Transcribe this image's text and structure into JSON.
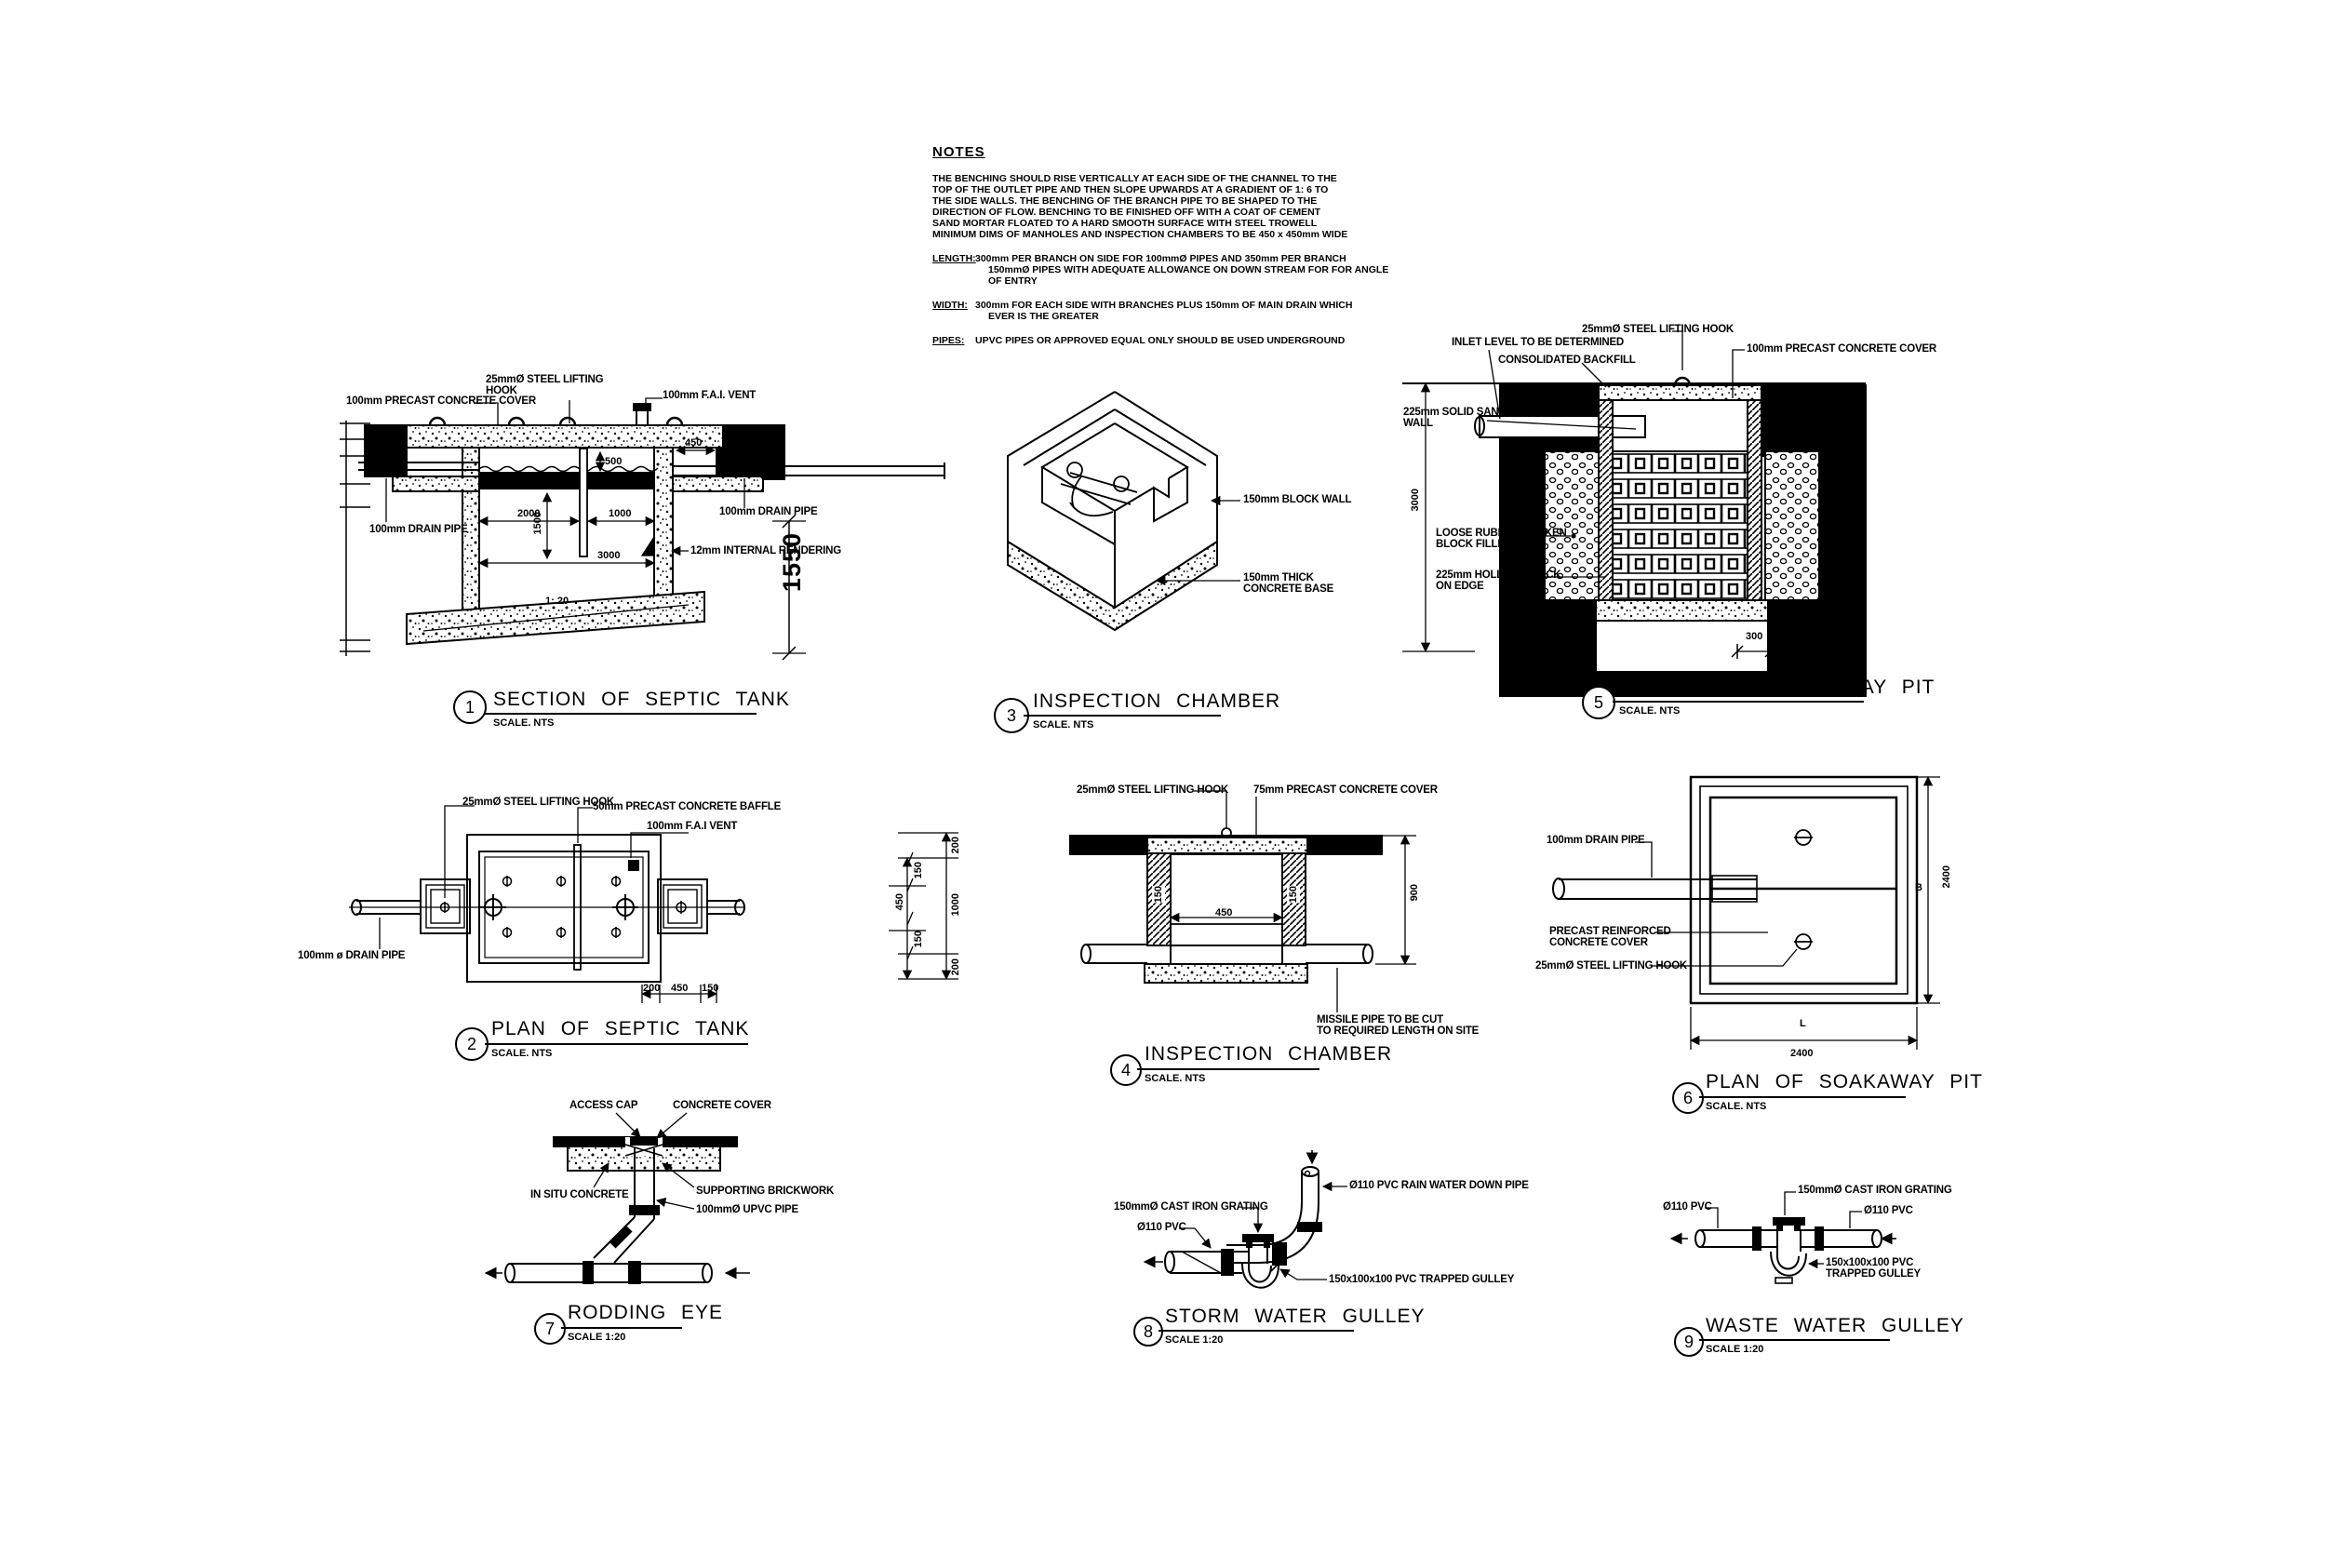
{
  "sheet": {
    "background": "#ffffff",
    "ink": "#000000"
  },
  "notes": {
    "title": "NOTES",
    "body": [
      "THE BENCHING SHOULD RISE VERTICALLY AT EACH SIDE OF THE CHANNEL TO THE",
      "TOP OF THE OUTLET PIPE AND THEN SLOPE UPWARDS AT A GRADIENT OF 1: 6 TO",
      "THE SIDE WALLS. THE BENCHING OF THE BRANCH PIPE TO BE SHAPED TO THE",
      "DIRECTION OF FLOW. BENCHING TO BE FINISHED OFF WITH A COAT OF CEMENT",
      "SAND MORTAR FLOATED TO A HARD SMOOTH SURFACE WITH STEEL TROWELL",
      "MINIMUM DIMS OF MANHOLES AND INSPECTION CHAMBERS TO BE 450 x 450mm WIDE"
    ],
    "length_term": "LENGTH:",
    "length_def": [
      "300mm PER BRANCH ON SIDE FOR 100mmØ PIPES AND 350mm PER BRANCH",
      "150mmØ PIPES WITH ADEQUATE ALLOWANCE ON DOWN STREAM FOR FOR ANGLE",
      "OF  ENTRY"
    ],
    "width_term": "WIDTH:",
    "width_def": [
      "300mm FOR EACH SIDE WITH BRANCHES PLUS 150mm OF MAIN DRAIN WHICH",
      "EVER  IS  THE  GREATER"
    ],
    "pipes_term": "PIPES:",
    "pipes_def": [
      "UPVC PIPES OR APPROVED EQUAL ONLY SHOULD BE USED UNDERGROUND"
    ]
  },
  "d1": {
    "num": "1",
    "title": "SECTION OF SEPTIC TANK",
    "scale": "SCALE. NTS",
    "labels": {
      "hook1": "25mmØ STEEL LIFTING",
      "hook2": "HOOK",
      "cover": "100mm PRECAST CONCRETE COVER",
      "vent": "100mm F.A.I. VENT",
      "drain_left": "100mm DRAIN PIPE",
      "drain_right": "100mm DRAIN PIPE",
      "render": "12mm INTERNAL RENDERING"
    },
    "dims": {
      "a": "450",
      "b": "500",
      "c": "2000",
      "d": "1000",
      "e": "1500",
      "f": "3000",
      "g": "1: 20",
      "h": "1550"
    }
  },
  "d2": {
    "num": "2",
    "title": "PLAN OF SEPTIC TANK",
    "scale": "SCALE.  NTS",
    "labels": {
      "hook": "25mmØ STEEL LIFTING HOOK",
      "baffle": "50mm PRECAST CONCRETE BAFFLE",
      "vent": "100mm F.A.I VENT",
      "drain": "100mm ø DRAIN PIPE"
    },
    "dims": {
      "b1": "200",
      "b2": "450",
      "b3": "150",
      "r1": "150",
      "r2": "450",
      "r3": "150",
      "o1": "200",
      "o2": "1000",
      "o3": "200"
    }
  },
  "d3": {
    "num": "3",
    "title": "INSPECTION CHAMBER",
    "scale": "SCALE. NTS",
    "labels": {
      "wall": "150mm BLOCK WALL",
      "base1": "150mm THICK",
      "base2": "CONCRETE BASE"
    }
  },
  "d4": {
    "num": "4",
    "title": "INSPECTION CHAMBER",
    "scale": "SCALE.  NTS",
    "labels": {
      "hook": "25mmØ STEEL LIFTING HOOK",
      "cover": "75mm PRECAST CONCRETE COVER",
      "pipe1": "MISSILE PIPE TO BE CUT",
      "pipe2": "TO REQUIRED LENGTH ON SITE"
    },
    "dims": {
      "w": "450",
      "wl": "150",
      "wr": "150",
      "h": "900"
    }
  },
  "d5": {
    "num": "5",
    "title": "SECTION OF SOAKAWAY PIT",
    "scale": "SCALE.  NTS",
    "labels": {
      "inlet": "INLET LEVEL TO BE DETERMINED",
      "backfill": "CONSOLIDATED BACKFILL",
      "hook": "25mmØ STEEL LIFTING HOOK",
      "cover": "100mm PRECAST CONCRETE COVER",
      "wall1": "225mm SOLID SANDCRETE",
      "wall2": "WALL",
      "rubble1": "LOOSE RUBBLE BROKEN",
      "rubble2": "BLOCK FILLING",
      "hollow1": "225mm HOLLOW BLOCK",
      "hollow2": "ON EDGE"
    },
    "dims": {
      "h": "3000",
      "b": "300"
    }
  },
  "d6": {
    "num": "6",
    "title": "PLAN OF SOAKAWAY PIT",
    "scale": "SCALE.  NTS",
    "labels": {
      "drain": "100mm DRAIN PIPE",
      "cover1": "PRECAST REINFORCED",
      "cover2": "CONCRETE COVER",
      "hook": "25mmØ STEEL LIFTING HOOK"
    },
    "dims": {
      "L": "L",
      "l": "2400",
      "B": "B",
      "b": "2400"
    }
  },
  "d7": {
    "num": "7",
    "title": "RODDING EYE",
    "scale": "SCALE 1:20",
    "labels": {
      "cap": "ACCESS CAP",
      "cover": "CONCRETE COVER",
      "insitu": "IN SITU CONCRETE",
      "brick": "SUPPORTING BRICKWORK",
      "pipe": "100mmØ UPVC PIPE"
    }
  },
  "d8": {
    "num": "8",
    "title": "STORM WATER GULLEY",
    "scale": "SCALE 1:20",
    "labels": {
      "down": "Ø110 PVC RAIN WATER DOWN PIPE",
      "grating": "150mmØ CAST IRON GRATING",
      "pvc": "Ø110 PVC",
      "trap": "150x100x100 PVC TRAPPED GULLEY"
    }
  },
  "d9": {
    "num": "9",
    "title": "WASTE WATER GULLEY",
    "scale": "SCALE 1:20",
    "labels": {
      "grating": "150mmØ CAST IRON GRATING",
      "pvc_l": "Ø110 PVC",
      "pvc_r": "Ø110 PVC",
      "trap1": "150x100x100 PVC",
      "trap2": "TRAPPED GULLEY"
    }
  }
}
